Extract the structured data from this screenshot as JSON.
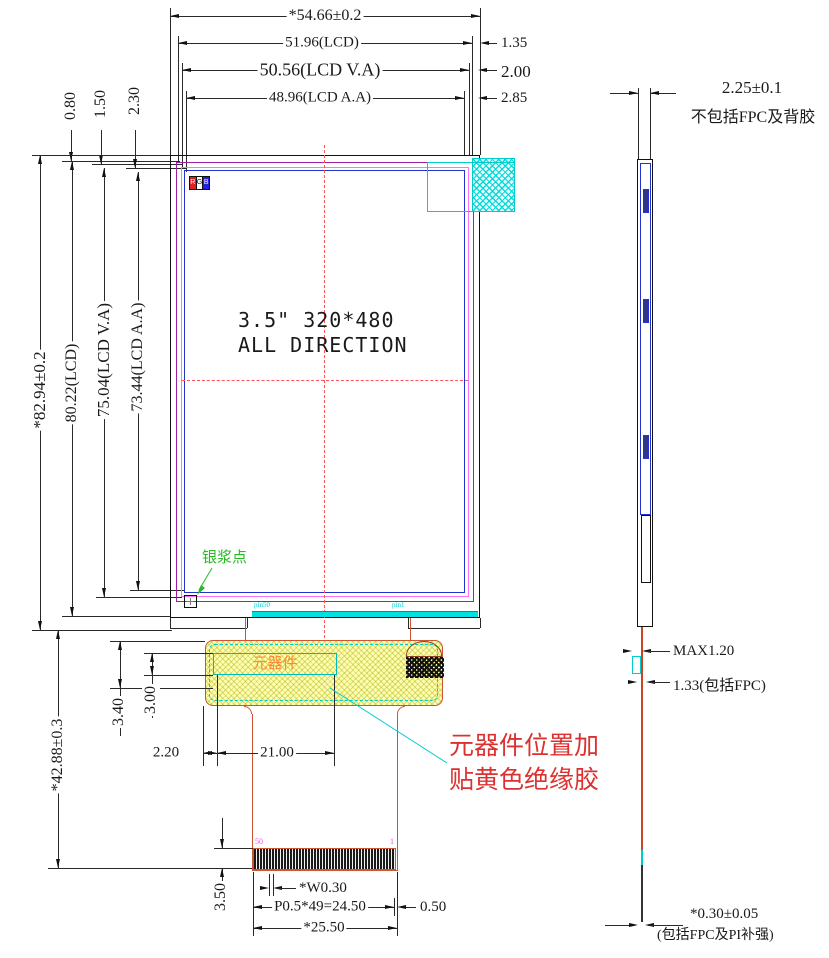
{
  "front": {
    "top_dims": [
      "*54.66±0.2",
      "51.96(LCD)",
      "50.56(LCD V.A)",
      "48.96(LCD A.A)"
    ],
    "right_offsets": [
      "1.35",
      "2.00",
      "2.85"
    ],
    "top_left_offsets": [
      "0.80",
      "1.50",
      "2.30"
    ],
    "left_dims": [
      "*82.94±0.2",
      "80.22(LCD)",
      "75.04(LCD V.A)",
      "73.44(LCD A.A)"
    ],
    "panel_size_text": "3.5\" 320*480",
    "panel_direction_text": "ALL DIRECTION",
    "rgb_marker": [
      "R",
      "G",
      "B"
    ],
    "silver_dot_label": "银浆点",
    "pin_label_left": "pin50",
    "pin_label_right": "pin1"
  },
  "fpc": {
    "component_label": "元器件",
    "note_line1": "元器件位置加",
    "note_line2": "贴黄色绝缘胶",
    "pin_start": "50",
    "pin_end": "1",
    "dims": {
      "offset": "2.20",
      "component_width": "21.00",
      "gap1": "3.00",
      "gap2": "3.40",
      "length": "*42.88±0.3",
      "contact_height": "3.50",
      "contact_width": "*W0.30",
      "pitch": "P0.5*49=24.50",
      "margin": "0.50",
      "tail_width": "*25.50"
    }
  },
  "side": {
    "thickness": "2.25±0.1",
    "thickness_note": "不包括FPC及背胶",
    "max_thickness": "MAX1.20",
    "fpc_thickness": "1.33(包括FPC)",
    "fpc_bottom_thickness": "*0.30±0.05",
    "fpc_bottom_note": "(包括FPC及PI补强)"
  },
  "colors": {
    "note_red": "#dd3030",
    "centerline_red": "#ff5555",
    "cyan": "#00cccc",
    "fpc_orange": "#cc5533",
    "green": "#22bb22",
    "lcd_purple": "#a020a0",
    "lcd_pink": "#ff70ff",
    "lcd_blue": "#2233cc",
    "tape_yellow": "#ffffb0"
  }
}
